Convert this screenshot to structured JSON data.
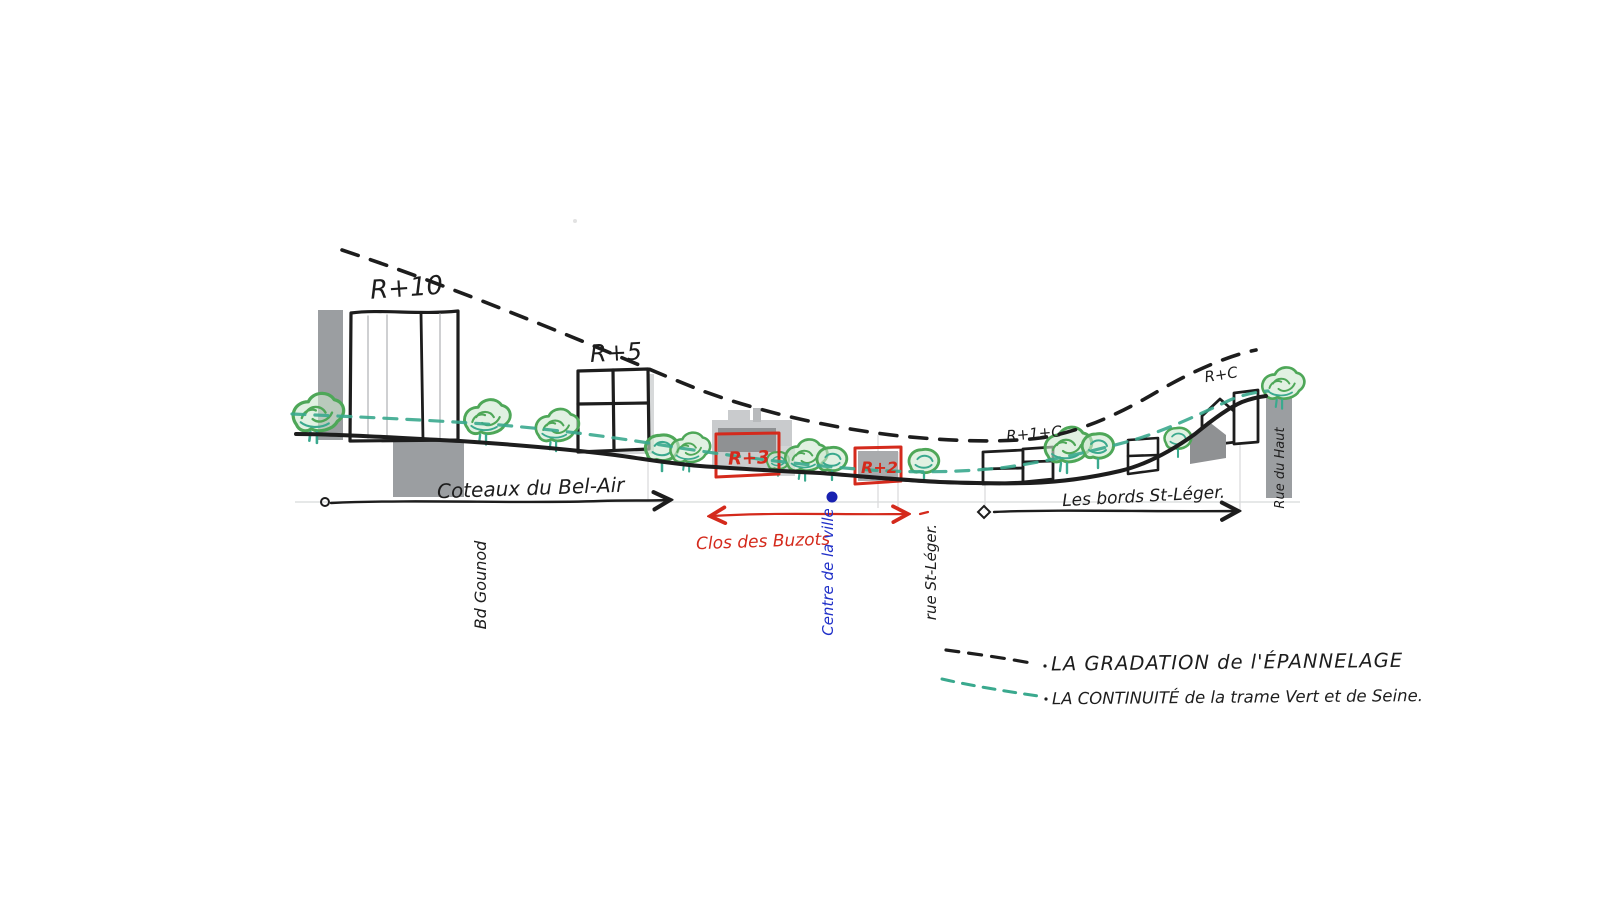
{
  "sketch": {
    "type": "hand-drawn urban section",
    "height_labels": {
      "r10": "R+10",
      "r5": "R+5",
      "r3": "R+3",
      "r2": "R+2",
      "r1c": "R+1+C",
      "rc": "R+C"
    },
    "zone_labels": {
      "coteaux": "Coteaux du Bel-Air",
      "clos": "Clos des Buzots",
      "bords": "Les bords St-Léger."
    },
    "street_labels": {
      "bd_gounod": "Bd Gounod",
      "rue_st_leger": "rue St-Léger.",
      "centre_ville": "Centre de la ville",
      "rue_du_haut": "Rue du Haut"
    },
    "legend": {
      "items": [
        {
          "label": "LA GRADATION de l'ÉPANNELAGE",
          "line_style": "black-dashed",
          "color": "#1d1d1d"
        },
        {
          "label": "LA CONTINUITÉ de la trame Vert et de Seine.",
          "line_style": "green-dashed",
          "color": "#3aa98e"
        }
      ]
    },
    "colors": {
      "ink": "#1d1d1d",
      "red": "#d42a1c",
      "blue": "#2030c8",
      "blue_dot": "#1821b0",
      "tree_green": "#4ea758",
      "teal_green": "#3aa98e",
      "gray_medium": "#9b9ea1",
      "gray_dark": "#8a8c8f",
      "gray_light": "#c9cbcd",
      "paper": "#ffffff"
    }
  }
}
